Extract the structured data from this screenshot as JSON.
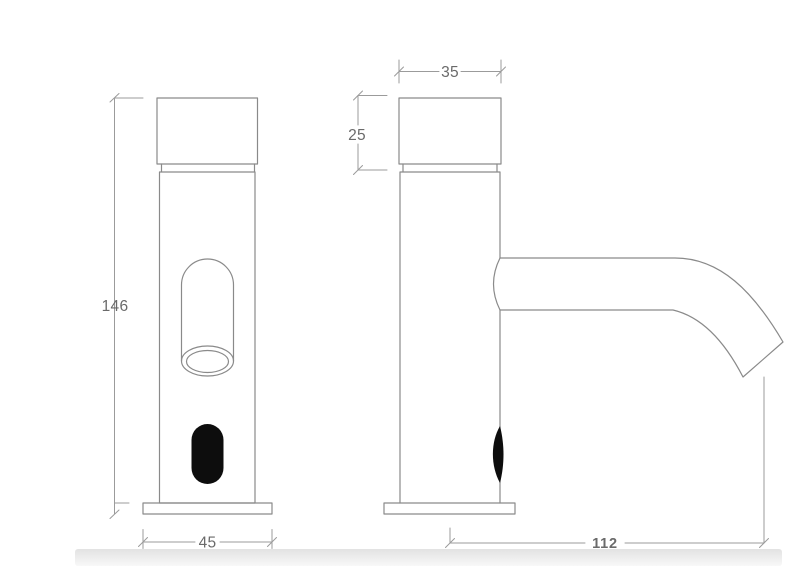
{
  "drawing": {
    "type": "technical-dimension-drawing",
    "subject": "sensor faucet, front view and side view",
    "dimensions": {
      "height_mm": "146",
      "base_width_mm": "45",
      "cap_width_mm": "35",
      "cap_height_mm": "25",
      "spout_reach_mm": "112"
    },
    "colors": {
      "background": "#ffffff",
      "outline": "#8a8a8a",
      "dim_line": "#9b9b9b",
      "label_text": "#6a6a6a",
      "sensor_black": "#0d0d0d",
      "band": "#e9e9e9"
    }
  }
}
